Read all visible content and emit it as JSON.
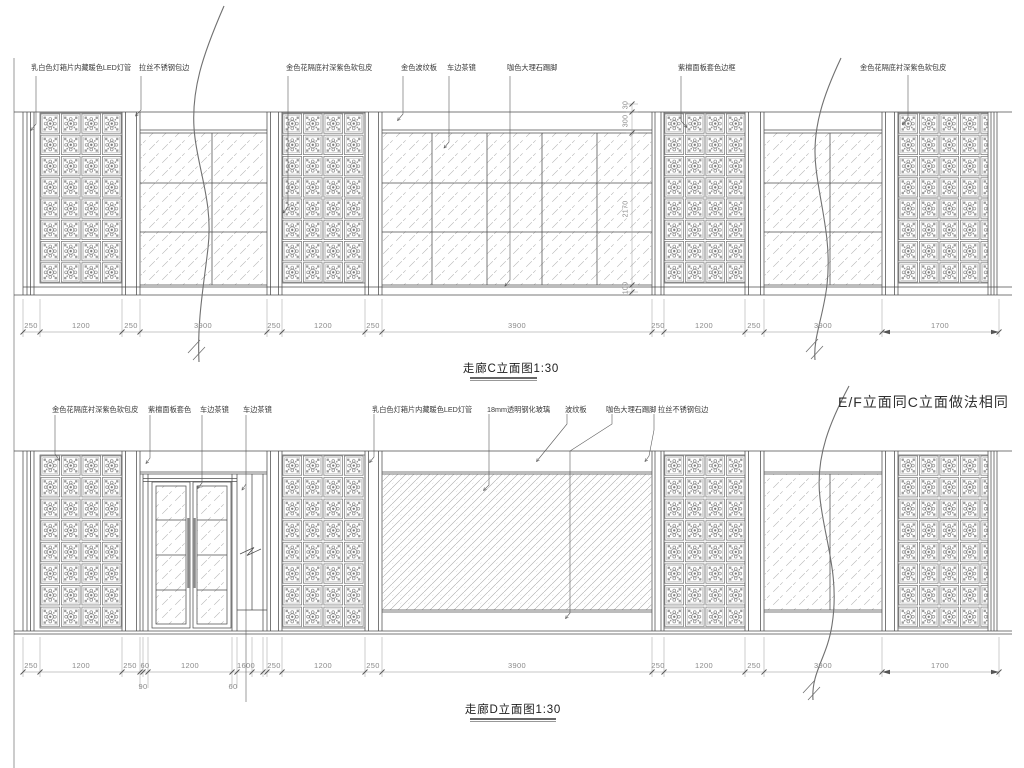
{
  "sheet": {
    "note_ef": "E/F立面同C立面做法相同"
  },
  "elevation_c": {
    "title": "走廊C立面图1:30",
    "callouts": [
      "乳白色灯箱片内藏暖色LED灯管",
      "拉丝不锈钢包边",
      "金色花隔底衬深紫色软包皮",
      "金色波纹板",
      "车边茶镜",
      "咖色大理石踢脚",
      "紫檀面板套色边框",
      "金色花隔底衬深紫色软包皮"
    ],
    "dims_bottom": [
      "250",
      "1200",
      "250",
      "3900",
      "250",
      "1200",
      "250",
      "3900",
      "250",
      "1200",
      "250",
      "3900",
      "1700"
    ],
    "dims_right": [
      "30",
      "300",
      "2170",
      "100"
    ]
  },
  "elevation_d": {
    "title": "走廊D立面图1:30",
    "callouts": [
      "金色花隔底衬深紫色软包皮",
      "紫檀面板套色",
      "车边茶镜",
      "车边茶镜",
      "乳白色灯箱片内藏暖色LED灯管",
      "18mm透明钢化玻璃",
      "波纹板",
      "咖色大理石踢脚",
      "拉丝不锈钢包边"
    ],
    "dims_bottom": [
      "250",
      "1200",
      "250",
      "60",
      "1200",
      "1600",
      "250",
      "1200",
      "250",
      "3900",
      "250",
      "1200",
      "250",
      "3900",
      "1700"
    ],
    "dims_sub": [
      "90",
      "60"
    ]
  }
}
